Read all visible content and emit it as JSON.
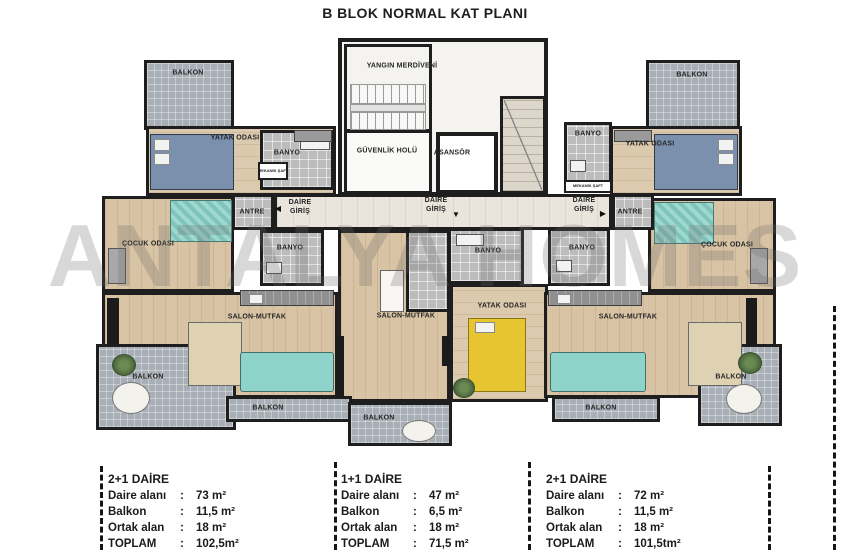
{
  "title": "B BLOK NORMAL KAT PLANI",
  "watermark": "ANTALYA HOMES",
  "icons": {
    "arrow_left": "◀",
    "arrow_down": "▼",
    "arrow_right": "▶"
  },
  "colors": {
    "wall": "#1e1e1e",
    "wood_floor": "#d8c3a4",
    "balcony_gray": "#a9afb7",
    "tile_gray": "#bcbcbc",
    "corridor": "#eae5dc",
    "sofa_teal": "#8ed4cb",
    "bed_blue": "#7b90ad",
    "bed_yellow": "#e6c531",
    "plant_green": "#55743f"
  },
  "plan": {
    "labels": {
      "balkon": "BALKON",
      "yatak_odasi": "YATAK ODASI",
      "banyo": "BANYO",
      "mekanik_saft": "MEKANİK ŞAFT",
      "antre": "ANTRE",
      "daire_giris": "DAİRE GİRİŞ",
      "cocuk_odasi": "ÇOCUK ODASI",
      "salon_mutfak": "SALON-MUTFAK",
      "yangin_merdiveni": "YANGIN MERDİVENİ",
      "guvenlik_holu": "GÜVENLİK HOLÜ",
      "asansor": "ASANSÖR"
    }
  },
  "colon": ":",
  "units": [
    {
      "type": "2+1 DAİRE",
      "rows": [
        {
          "label": "Daire alanı",
          "value": "73 m²"
        },
        {
          "label": "Balkon",
          "value": "11,5 m²"
        },
        {
          "label": "Ortak alan",
          "value": "18 m²"
        },
        {
          "label": "TOPLAM",
          "value": "102,5m²"
        }
      ]
    },
    {
      "type": "1+1 DAİRE",
      "rows": [
        {
          "label": "Daire alanı",
          "value": "47 m²"
        },
        {
          "label": "Balkon",
          "value": "6,5 m²"
        },
        {
          "label": "Ortak alan",
          "value": "18 m²"
        },
        {
          "label": "TOPLAM",
          "value": "71,5 m²"
        }
      ]
    },
    {
      "type": "2+1 DAİRE",
      "rows": [
        {
          "label": "Daire alanı",
          "value": "72 m²"
        },
        {
          "label": "Balkon",
          "value": "11,5 m²"
        },
        {
          "label": "Ortak alan",
          "value": "18 m²"
        },
        {
          "label": "TOPLAM",
          "value": "101,5tm²"
        }
      ]
    }
  ]
}
